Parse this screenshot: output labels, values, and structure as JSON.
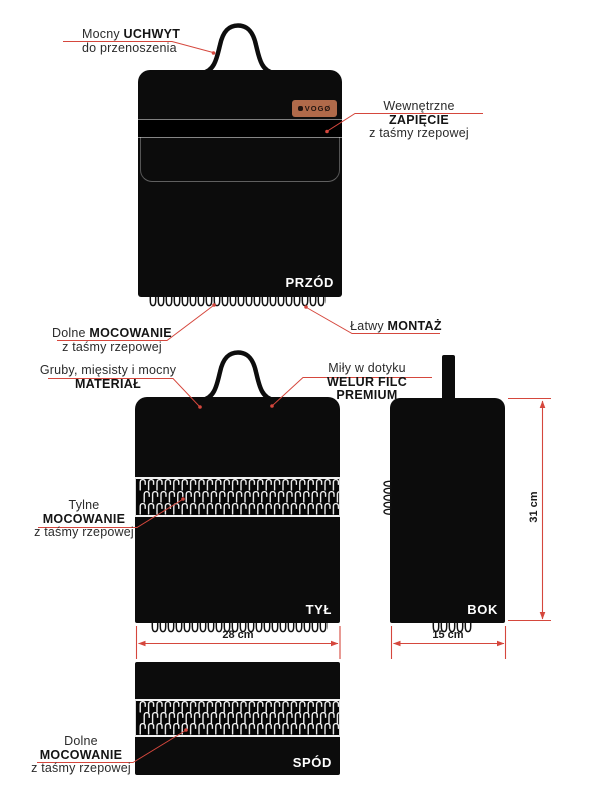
{
  "brand": {
    "badge_text": "VOGØ"
  },
  "views": {
    "front": {
      "label": "PRZÓD"
    },
    "back": {
      "label": "TYŁ"
    },
    "side": {
      "label": "BOK"
    },
    "bottom": {
      "label": "SPÓD"
    }
  },
  "callouts": {
    "handle": {
      "regular": "Mocny ",
      "bold": "UCHWYT",
      "line2": "do przenoszenia"
    },
    "inner_fastening": {
      "regular": "Wewnętrzne ",
      "bold": "ZAPIĘCIE",
      "line2": "z taśmy rzepowej"
    },
    "front_bottom_mount": {
      "regular": "Dolne ",
      "bold": "MOCOWANIE",
      "line2": "z taśmy rzepowej"
    },
    "easy_mount": {
      "regular": "Łatwy ",
      "bold": "MONTAŻ"
    },
    "material": {
      "line1": "Gruby, mięsisty i mocny",
      "bold": "MATERIAŁ"
    },
    "velour": {
      "line1": "Miły w dotyku",
      "bold": "WELUR FILC PREMIUM"
    },
    "rear_mount": {
      "line1": "Tylne",
      "bold": "MOCOWANIE",
      "line3": "z taśmy rzepowej"
    },
    "bottom_mount": {
      "line1": "Dolne",
      "bold": "MOCOWANIE",
      "line3": "z taśmy rzepowej"
    }
  },
  "dimensions": {
    "back_width": "28 cm",
    "side_width": "15 cm",
    "side_height": "31 cm"
  },
  "colors": {
    "bag_black": "#0c0c0c",
    "accent_red": "#d5473d",
    "badge_copper": "#b06a4a",
    "strip_border_white": "#f2f2f2"
  }
}
